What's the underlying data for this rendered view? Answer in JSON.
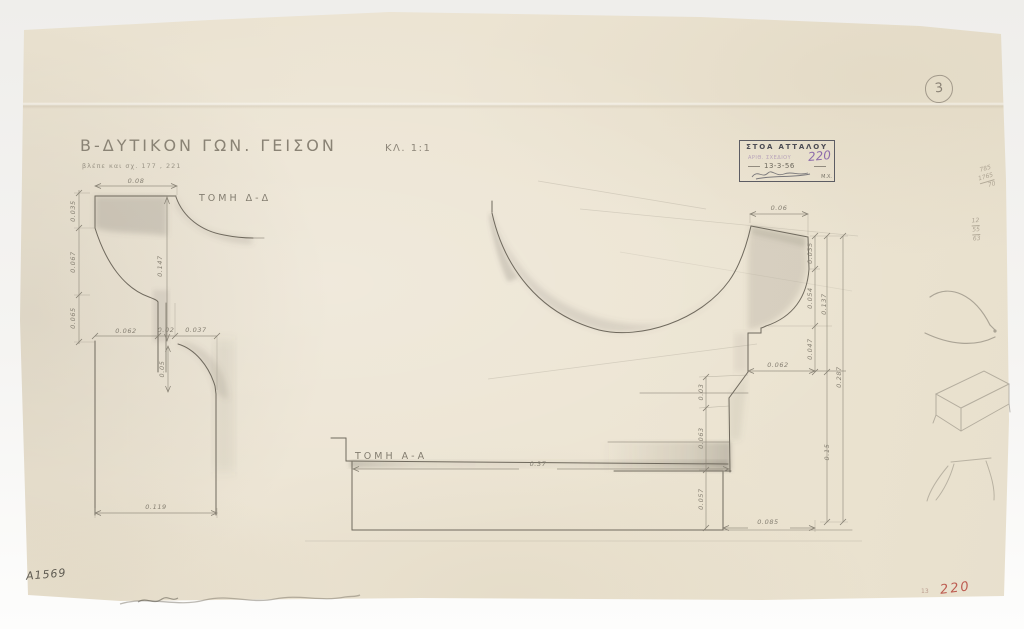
{
  "page": {
    "circled_number": "3",
    "inventory_number": "Α1569",
    "red_number": "220",
    "red_number_prefix": "13"
  },
  "title": {
    "main": "Β-ΔΥΤΙΚΟΝ ΓΩΝ. ΓΕΙΣΟΝ",
    "scale": "ΚΛ. 1:1",
    "reference": "βλέπε και σχ. 177 , 221"
  },
  "stamp": {
    "name": "ΣΤΟΑ ΑΤΤΑΛΟΥ",
    "number_label": "ΑΡΙΘ. ΣΧΕΔΙΟΥ",
    "number": "220",
    "date": "13-3-56",
    "initials": "Μ.Χ."
  },
  "sections": {
    "dd": "ΤΟΜΗ Δ-Δ",
    "aa": "ΤΟΜΗ Α-Α"
  },
  "dims": {
    "dd_top": "0.08",
    "dd_v1": "0.035",
    "dd_v2": "0.067",
    "dd_v3": "0.065",
    "dd_face": "0.147",
    "dd_b1": "0.062",
    "dd_b2": "0.02",
    "dd_b3": "0.037",
    "dd_cove": "0.05",
    "dd_base": "0.119",
    "mp_top": "0.06",
    "mp_r1": "0.035",
    "mp_r2": "0.054",
    "mp_r3": "0.047",
    "mp_rsum": "0.137",
    "mp_offset": "0.062",
    "mp_total": "0.287",
    "mp_lower": "0.15",
    "mp_l1": "0.03",
    "mp_l2": "0.063",
    "mp_l3": "0.057",
    "mp_base": "0.085",
    "aa_width": "0.37"
  },
  "pencil_notes": {
    "calc1": [
      "785",
      "1765",
      "70"
    ],
    "calc2": [
      "12",
      "55",
      "63"
    ]
  },
  "colors": {
    "paper": "#ebe3d1",
    "line": "#6f695d",
    "dim_text": "#857f72",
    "stamp_ink": "#4d4d55",
    "stamp_purple": "#8d6cab",
    "red_stamp": "#b6463c"
  }
}
